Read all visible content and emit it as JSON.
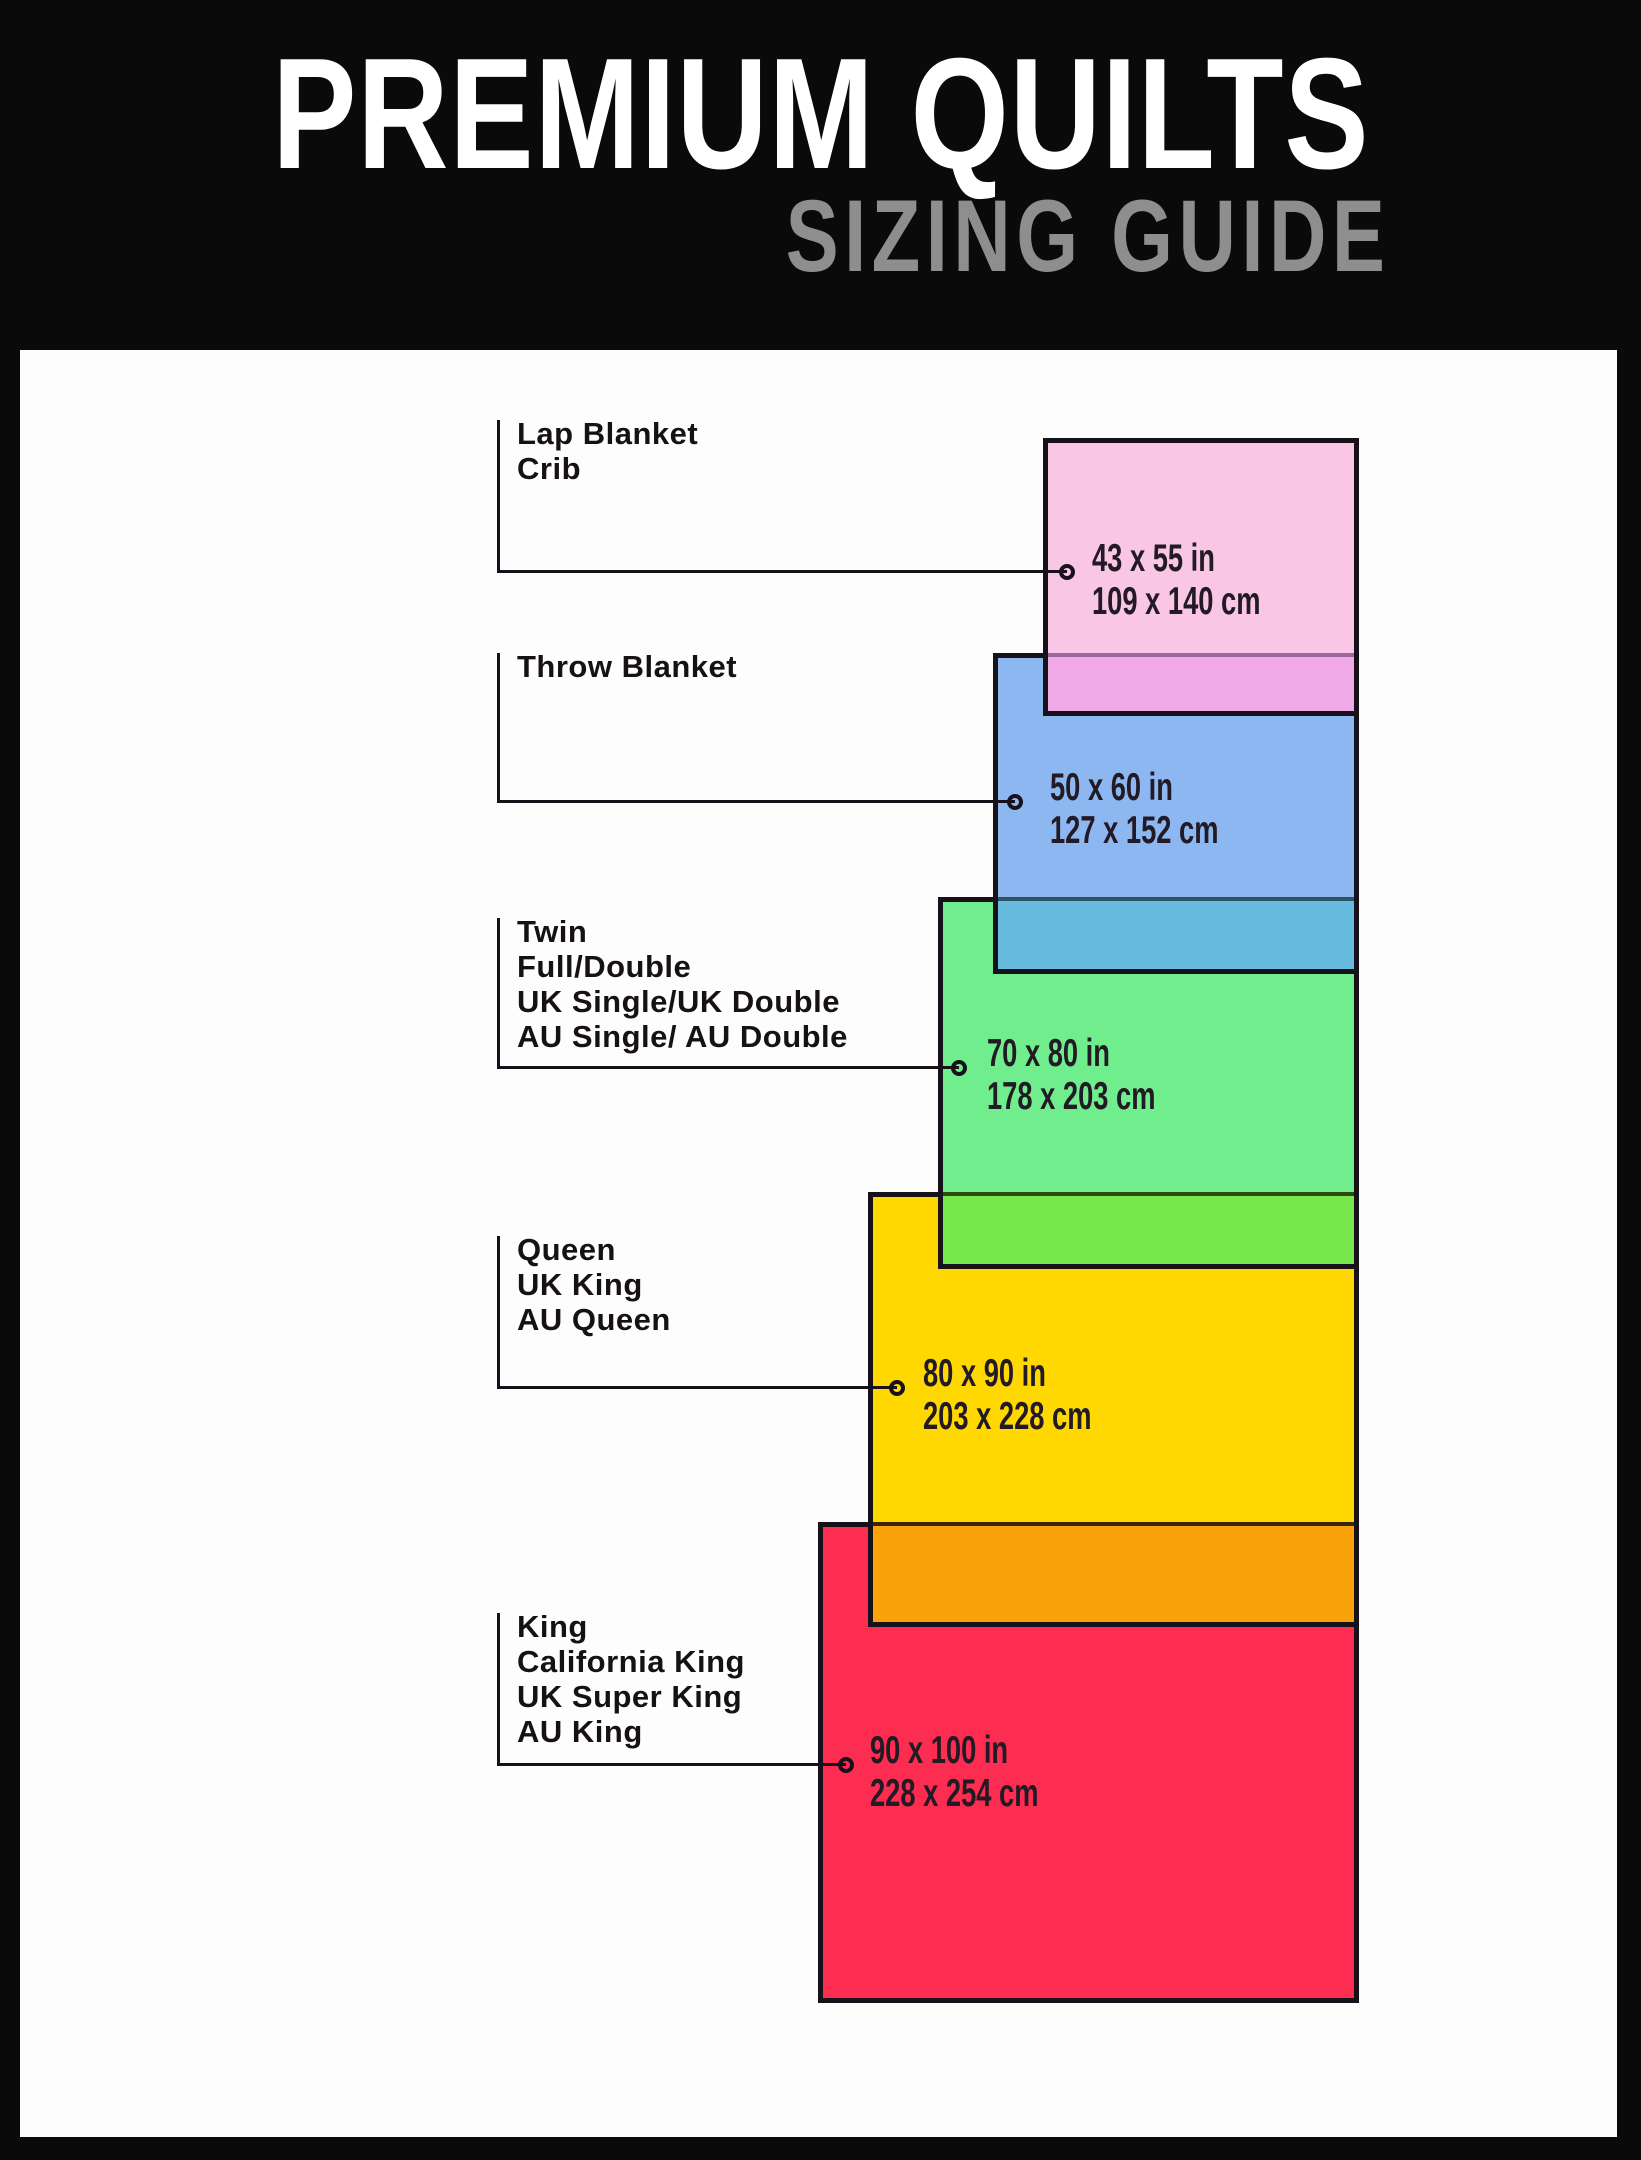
{
  "header": {
    "title": "PREMIUM QUILTS",
    "subtitle": "SIZING GUIDE",
    "background": "#0a0a0a",
    "title_color": "#ffffff",
    "subtitle_color": "#8e8e8e"
  },
  "canvas": {
    "background": "#fdfdfd",
    "line_color": "#171119"
  },
  "sizes": [
    {
      "id": "lap-blanket-crib",
      "labels": [
        "Lap Blanket",
        "Crib"
      ],
      "inches": "43 x 55 in",
      "cm": "109 x 140 cm",
      "colors": {
        "fill": "#f9c6e6",
        "overlap_fill": "#efaae7",
        "overlap_line": "#9a689c"
      }
    },
    {
      "id": "throw-blanket",
      "labels": [
        "Throw Blanket"
      ],
      "inches": "50 x 60 in",
      "cm": "127 x 152 cm",
      "colors": {
        "fill": "#8db7f1",
        "overlap_fill": "#66bbdf",
        "overlap_line": "#2b5564"
      }
    },
    {
      "id": "twin-full-double",
      "labels": [
        "Twin",
        "Full/Double",
        "UK Single/UK Double",
        "AU Single/ AU Double"
      ],
      "inches": "70 x 80 in",
      "cm": "178 x 203 cm",
      "colors": {
        "fill": "#70ee8d",
        "overlap_fill": "#78e74b",
        "overlap_line": "#2f4a0e"
      }
    },
    {
      "id": "queen-uk-king-au-queen",
      "labels": [
        "Queen",
        "UK King",
        "AU Queen"
      ],
      "inches": "80 x 90 in",
      "cm": "203 x 228 cm",
      "colors": {
        "fill": "#ffd802",
        "overlap_fill": "#faa20a",
        "overlap_line": "#3a2508"
      }
    },
    {
      "id": "king-california-king",
      "labels": [
        "King",
        "California King",
        "UK Super King",
        "AU King"
      ],
      "inches": "90 x 100 in",
      "cm": "228 x 254 cm",
      "colors": {
        "fill": "#fc2d50"
      }
    }
  ]
}
